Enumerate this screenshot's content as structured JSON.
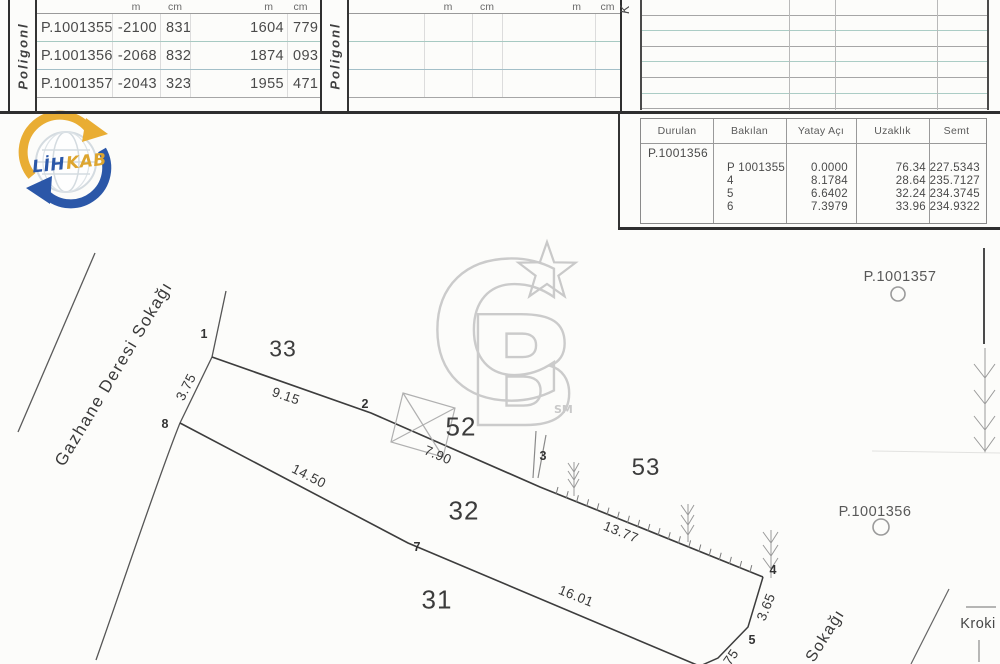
{
  "poligon_tables": {
    "section_label": "Poligonl",
    "unit_headers": [
      "m",
      "cm",
      "m",
      "cm"
    ],
    "left_rows": [
      [
        "P.1001355",
        "-2100",
        "831",
        "1604",
        "779"
      ],
      [
        "P.1001356",
        "-2068",
        "832",
        "1874",
        "093"
      ],
      [
        "P.1001357",
        "-2043",
        "323",
        "1955",
        "471"
      ]
    ],
    "corner_label": "K"
  },
  "observation_table": {
    "headers": [
      "Durulan",
      "Bakılan",
      "Yatay  Açı",
      "Uzaklık",
      "Semt"
    ],
    "station": "P.1001356",
    "rows": [
      [
        "P 1001355",
        "0.0000",
        "76.34",
        "227.5343"
      ],
      [
        "4",
        "8.1784",
        "28.64",
        "235.7127"
      ],
      [
        "5",
        "6.6402",
        "32.24",
        "234.3745"
      ],
      [
        "6",
        "7.3979",
        "33.96",
        "234.9322"
      ]
    ]
  },
  "logo": {
    "primary": "LİH",
    "secondary": "KAB"
  },
  "watermark": {
    "c": "C",
    "b": "B",
    "sm": "SM"
  },
  "sketch": {
    "street_main": "Gazhane Deresi Sokağı",
    "street_secondary": "Sokağı",
    "kroki_label": "Kroki",
    "parcels": [
      {
        "label": "33",
        "x": 283,
        "y": 349,
        "size": 23
      },
      {
        "label": "52",
        "x": 461,
        "y": 427,
        "size": 26
      },
      {
        "label": "53",
        "x": 646,
        "y": 468,
        "size": 24
      },
      {
        "label": "32",
        "x": 464,
        "y": 511,
        "size": 26
      },
      {
        "label": "31",
        "x": 437,
        "y": 600,
        "size": 26
      }
    ],
    "points": [
      {
        "label": "1",
        "x": 204,
        "y": 334
      },
      {
        "label": "2",
        "x": 365,
        "y": 404
      },
      {
        "label": "3",
        "x": 543,
        "y": 456
      },
      {
        "label": "4",
        "x": 773,
        "y": 570
      },
      {
        "label": "5",
        "x": 752,
        "y": 640
      },
      {
        "label": "7",
        "x": 417,
        "y": 547
      },
      {
        "label": "8",
        "x": 165,
        "y": 424
      }
    ],
    "dimensions": [
      {
        "label": "3.75",
        "x": 186,
        "y": 387,
        "rot": -63
      },
      {
        "label": "9.15",
        "x": 286,
        "y": 396,
        "rot": 19
      },
      {
        "label": "7.90",
        "x": 438,
        "y": 455,
        "rot": 23
      },
      {
        "label": "13.77",
        "x": 621,
        "y": 532,
        "rot": 22
      },
      {
        "label": "14.50",
        "x": 309,
        "y": 476,
        "rot": 27
      },
      {
        "label": "16.01",
        "x": 576,
        "y": 596,
        "rot": 22
      },
      {
        "label": "3.65",
        "x": 766,
        "y": 607,
        "rot": -68
      },
      {
        "label": "75",
        "x": 731,
        "y": 657,
        "rot": -55
      }
    ],
    "benchmarks": [
      {
        "label": "P.1001357",
        "x": 900,
        "y": 277
      },
      {
        "label": "P.1001356",
        "x": 875,
        "y": 512
      }
    ]
  }
}
